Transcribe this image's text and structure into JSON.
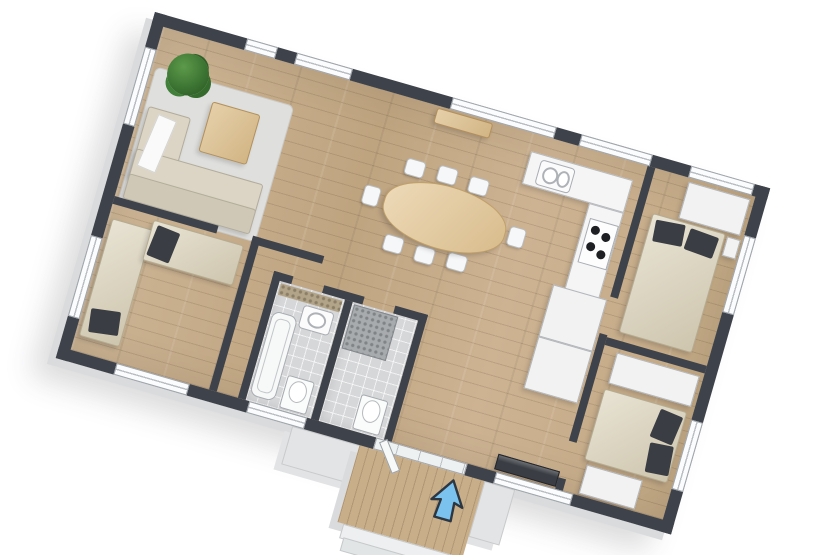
{
  "scene": {
    "description": "3D top-down floor plan of a three-bedroom house, rendered rotated on a white background",
    "rotation_deg": 16,
    "background": "#ffffff"
  },
  "colors": {
    "wall": "#3e424a",
    "wall_side_face": "#dadbdd",
    "wood_floor": "#c7ad8c",
    "deck_floor": "#c9ae8a",
    "tile_floor": "#d6d7d9",
    "counter": "#f5f5f6",
    "bed_duvet": "#d9d0b7",
    "bed_pillow": "#3a3d43",
    "sofa": "#dcd5c5",
    "table_wood": "#e5c794",
    "plant": "#3c7433",
    "entrance_arrow": "#7cc2ee"
  },
  "rooms": [
    {
      "id": "living-room",
      "label": "Living room",
      "furniture": [
        "sofa",
        "rug",
        "coffee-table",
        "plant"
      ]
    },
    {
      "id": "dining-area",
      "label": "Dining area",
      "furniture": [
        "oval-dining-table",
        "eight-chairs",
        "wall-sideboard"
      ]
    },
    {
      "id": "kitchen",
      "label": "Kitchen",
      "furniture": [
        "l-shaped-counter",
        "sink",
        "cooktop"
      ]
    },
    {
      "id": "bedroom-left",
      "label": "Bedroom (left)",
      "furniture": [
        "single-bed-vertical",
        "single-bed-horizontal"
      ]
    },
    {
      "id": "bathroom-left",
      "label": "Bathroom",
      "furniture": [
        "bathtub",
        "sink",
        "toilet",
        "mosaic-strip"
      ]
    },
    {
      "id": "bathroom-right",
      "label": "Shower room",
      "furniture": [
        "shower",
        "toilet"
      ]
    },
    {
      "id": "hallway",
      "label": "Hallway",
      "furniture": [
        "closet-block",
        "tv-sideboard"
      ]
    },
    {
      "id": "bedroom-top-right",
      "label": "Bedroom (top right)",
      "furniture": [
        "double-bed",
        "wardrobe",
        "nightstand"
      ]
    },
    {
      "id": "bedroom-bottom-right",
      "label": "Bedroom (bottom right)",
      "furniture": [
        "double-bed",
        "wardrobe",
        "dresser"
      ]
    },
    {
      "id": "entrance-porch",
      "label": "Entrance porch",
      "furniture": [
        "wood-deck",
        "steps",
        "entrance-arrow"
      ]
    }
  ],
  "entrance": {
    "arrow_color": "#7cc2ee",
    "arrow_outline": "#2d3742",
    "arrow_direction": "pointing into the house"
  }
}
